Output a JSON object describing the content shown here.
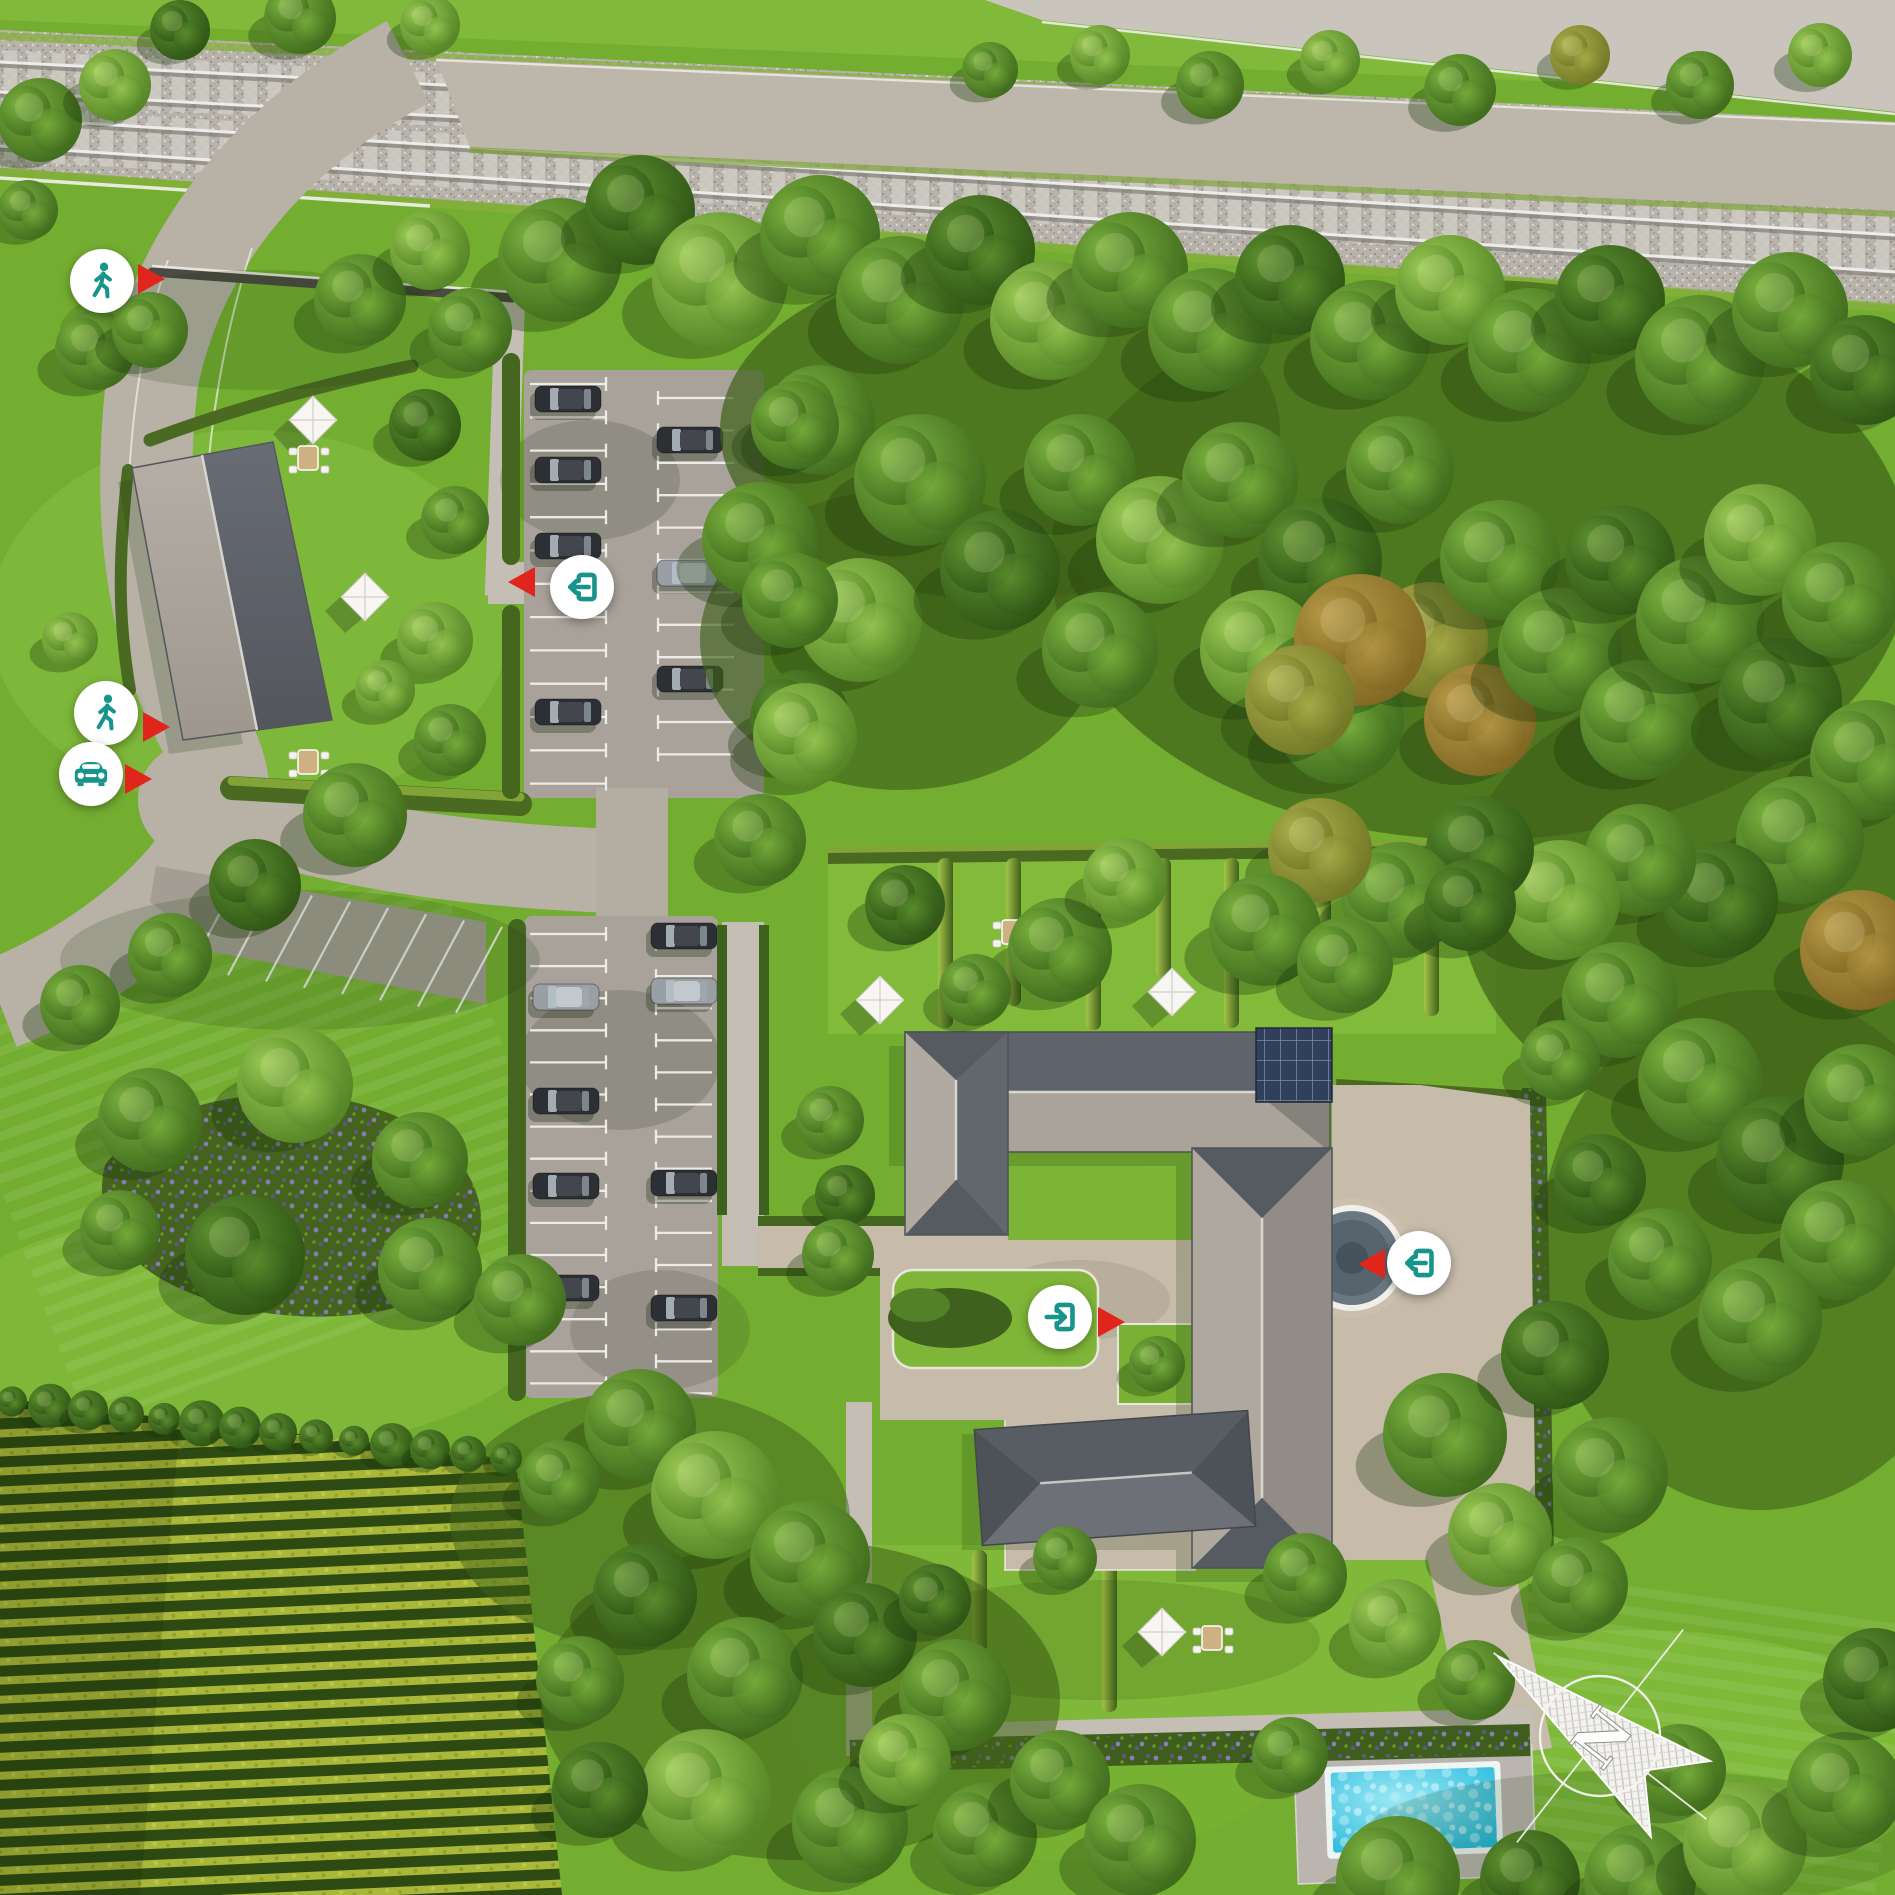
{
  "scene": {
    "type": "aerial-3d-site-plan",
    "compass": {
      "label": "N"
    }
  },
  "palette": {
    "accent_teal": "#17948c",
    "marker_red": "#e0251c",
    "grass": "#77b133",
    "asphalt": "#b7b1a6",
    "paving_tan": "#c3b29c",
    "roof_light": "#aba49b",
    "roof_dark": "#5d6168",
    "hedge": "#45661f",
    "pool_water": "#3cc6e4",
    "rail_ballast": "#b6b2aa",
    "vine_row": "#a9b838"
  },
  "markers": [
    {
      "id": "pedestrian-access-north",
      "icon": "pedestrian-icon",
      "label": "Pedestrian access (north)",
      "arrow": "right"
    },
    {
      "id": "pedestrian-access-west",
      "icon": "pedestrian-icon",
      "label": "Pedestrian access (west)",
      "arrow": "right"
    },
    {
      "id": "car-access-west",
      "icon": "car-icon",
      "label": "Car access (west)",
      "arrow": "right"
    },
    {
      "id": "parking-entrance",
      "icon": "entrance-icon",
      "label": "Parking entrance",
      "arrow": "left"
    },
    {
      "id": "courtyard-entrance",
      "icon": "entrance-icon",
      "label": "Courtyard entrance",
      "arrow": "right"
    },
    {
      "id": "plaza-entrance",
      "icon": "entrance-icon",
      "label": "Plaza entrance",
      "arrow": "left"
    }
  ],
  "features": {
    "railway_tracks": 2,
    "parking_lots": 2,
    "visible_cars": 15,
    "buildings": [
      "guest-house",
      "u-shaped-main-building"
    ],
    "landscape": [
      "forest",
      "vineyard",
      "hedged-gardens",
      "flower-bed"
    ],
    "amenities": [
      "fountain",
      "swimming-pool",
      "garden-furniture"
    ]
  }
}
